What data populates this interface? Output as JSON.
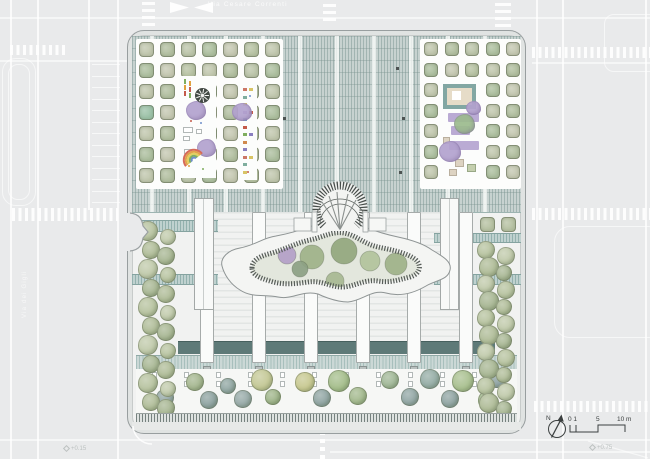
{
  "title": "Schoolyard roof and garden plan",
  "streets": {
    "top_label": "Via Cesare Correnti",
    "left_label": "Via dei Gigli"
  },
  "compass": {
    "label": "N"
  },
  "scalebar": {
    "zero": "0 1",
    "five": "5",
    "ten": "10 m"
  },
  "annotations": {
    "spot_left": "+0.15",
    "spot_right": "+0.75"
  },
  "palette": {
    "street_bg": "#e9eaeb",
    "site_fill": "#f1f2f1",
    "deck": "#c7d2d0",
    "dark_bar": "#5e7a78",
    "walkway": "#bfd1cf",
    "band": "#cbd8d6",
    "purple": "#b3a2cf",
    "sandbox_frame": "#82a7a3",
    "sandbox_fill": "#e6dcc8",
    "ink": "#3c4040"
  },
  "plan": {
    "deck_strip_xs": [
      152,
      189,
      226,
      263,
      300,
      337,
      374,
      411,
      448,
      485
    ],
    "deck_markers": [
      [
        277,
        67
      ],
      [
        283,
        117
      ],
      [
        280,
        171
      ],
      [
        396,
        67
      ],
      [
        402,
        117
      ],
      [
        399,
        171
      ]
    ],
    "pilaster_xs": [
      200,
      252,
      304,
      356,
      407,
      459
    ],
    "dark_bars": [
      [
        178,
        22
      ],
      [
        214,
        38
      ],
      [
        266,
        38
      ],
      [
        318,
        38
      ],
      [
        370,
        37
      ],
      [
        421,
        38
      ],
      [
        473,
        22
      ]
    ],
    "plaza_left": {
      "x0": 139,
      "y0": 42,
      "cols": 7,
      "rows": 7,
      "pitch": 21,
      "size": 15
    },
    "plaza_right": {
      "x0": 424,
      "y0": 42,
      "cols": 5,
      "rows": 7,
      "pitch": 20.5,
      "size": 14
    },
    "square_tree_colors": [
      "#c1c7ae",
      "#b7c2a3",
      "#c5c8b2",
      "#adbf9f",
      "#bcc5aa",
      "#b2bfa0"
    ],
    "accent_tree": {
      "plaza": "left",
      "col": 0,
      "row": 3,
      "color": "#9cc2a8"
    },
    "right_square_trees": [
      [
        480,
        217
      ],
      [
        501,
        217
      ]
    ],
    "flank_left": {
      "x1": 149,
      "x2": 167,
      "y0": 231,
      "step": 19,
      "rows": 10
    },
    "flank_right": {
      "x1": 487,
      "x2": 505,
      "y0": 250,
      "step": 17,
      "rows": 10
    },
    "flank_colors": [
      "#b6c29e",
      "#aebb96",
      "#bfc9a9",
      "#a6b591"
    ],
    "bottom_trees": [
      [
        195,
        382,
        9,
        "#a3b58d"
      ],
      [
        228,
        386,
        8,
        "#8ea4a0"
      ],
      [
        262,
        380,
        11,
        "#c3c794"
      ],
      [
        305,
        382,
        10,
        "#c6c78e"
      ],
      [
        339,
        381,
        11,
        "#a4bd8a"
      ],
      [
        390,
        380,
        9,
        "#9fb695"
      ],
      [
        430,
        379,
        10,
        "#93aba4"
      ],
      [
        463,
        381,
        11,
        "#a8bf8e"
      ],
      [
        497,
        378,
        10,
        "#8fa3a3"
      ],
      [
        165,
        398,
        9,
        "#91a5a3"
      ],
      [
        209,
        400,
        9,
        "#8ba09e"
      ],
      [
        243,
        399,
        9,
        "#95a8a6"
      ],
      [
        273,
        397,
        8,
        "#9db387"
      ],
      [
        322,
        398,
        9,
        "#8ea3a1"
      ],
      [
        358,
        396,
        9,
        "#a2b88c"
      ],
      [
        410,
        397,
        9,
        "#90a5a3"
      ],
      [
        450,
        399,
        9,
        "#8da2a0"
      ],
      [
        487,
        400,
        9,
        "#9fb68a"
      ]
    ],
    "blob_trees": [
      [
        287,
        255,
        9,
        "#b4a0c7"
      ],
      [
        312,
        257,
        12,
        "#9fb288"
      ],
      [
        344,
        251,
        13,
        "#93a87d"
      ],
      [
        370,
        261,
        10,
        "#b2c49c"
      ],
      [
        396,
        264,
        11,
        "#9fb288"
      ],
      [
        424,
        279,
        9,
        "#9fb0ab"
      ],
      [
        300,
        269,
        8,
        "#8da184"
      ],
      [
        335,
        281,
        9,
        "#a8b992"
      ]
    ],
    "furniture_cx": [
      152,
      184,
      216,
      248,
      280,
      312,
      344,
      376,
      408,
      440,
      472,
      500
    ],
    "hopscotch": {
      "x": 243,
      "y0": 88,
      "step": 7.5,
      "count": 12,
      "colors": [
        "#cc7766",
        "#7fae9e",
        "#d8c465",
        "#9a86c0",
        "#6f9fc9",
        "#c45a4a",
        "#7fae5e",
        "#d08a4e",
        "#8a7fc0",
        "#cc7766",
        "#7fae9e",
        "#d8c465"
      ]
    },
    "dash_stack": {
      "x": 184,
      "y0": 79,
      "count": 3,
      "colors": [
        "#7fae5e",
        "#e0a13e",
        "#c45a4a"
      ]
    },
    "confetti": [
      [
        190,
        120,
        "#c45a4a"
      ],
      [
        200,
        122,
        "#6f8fc9"
      ],
      [
        188,
        165,
        "#e0a13e"
      ],
      [
        202,
        168,
        "#7fae5e"
      ],
      [
        247,
        171,
        "#c45a4a"
      ],
      [
        249,
        95,
        "#6f8fc9"
      ]
    ],
    "rainbow_colors": [
      "#d66a5a",
      "#e2a24b",
      "#e3cf5e",
      "#7fae5e",
      "#6f8fc9"
    ],
    "arch_spokes": [
      [
        322,
        202
      ],
      [
        329,
        196
      ],
      [
        337,
        192
      ],
      [
        348,
        194
      ],
      [
        356,
        200
      ]
    ],
    "street": {
      "v_lines": [
        [
          10,
          0,
          459
        ],
        [
          37,
          0,
          459
        ],
        [
          88,
          0,
          210
        ],
        [
          117,
          0,
          459
        ],
        [
          536,
          0,
          459
        ],
        [
          562,
          0,
          459
        ],
        [
          645,
          0,
          459
        ]
      ],
      "h_lines": [
        [
          0,
          17,
          650
        ],
        [
          0,
          439,
          650
        ],
        [
          330,
          451,
          320
        ],
        [
          0,
          60,
          130
        ],
        [
          532,
          62,
          118
        ]
      ],
      "stall_rows": {
        "x": 92,
        "w": 28,
        "y0": 64,
        "step": 11.5,
        "count": 13
      },
      "park_rects": [
        [
          2,
          58,
          34,
          148,
          14
        ],
        [
          8,
          64,
          22,
          136,
          10
        ],
        [
          604,
          14,
          60,
          58,
          10
        ],
        [
          554,
          226,
          110,
          112,
          16
        ]
      ],
      "cross_h": [
        [
          12,
          208,
          106,
          13
        ],
        [
          10,
          45,
          57,
          10
        ],
        [
          532,
          208,
          118,
          12
        ],
        [
          532,
          47,
          118,
          11
        ],
        [
          534,
          401,
          116,
          11
        ]
      ],
      "cross_v": [
        [
          142,
          0,
          13,
          26
        ],
        [
          323,
          0,
          13,
          21
        ],
        [
          495,
          0,
          16,
          27
        ]
      ],
      "dash_center": [
        320,
        431,
        5,
        28
      ]
    }
  }
}
